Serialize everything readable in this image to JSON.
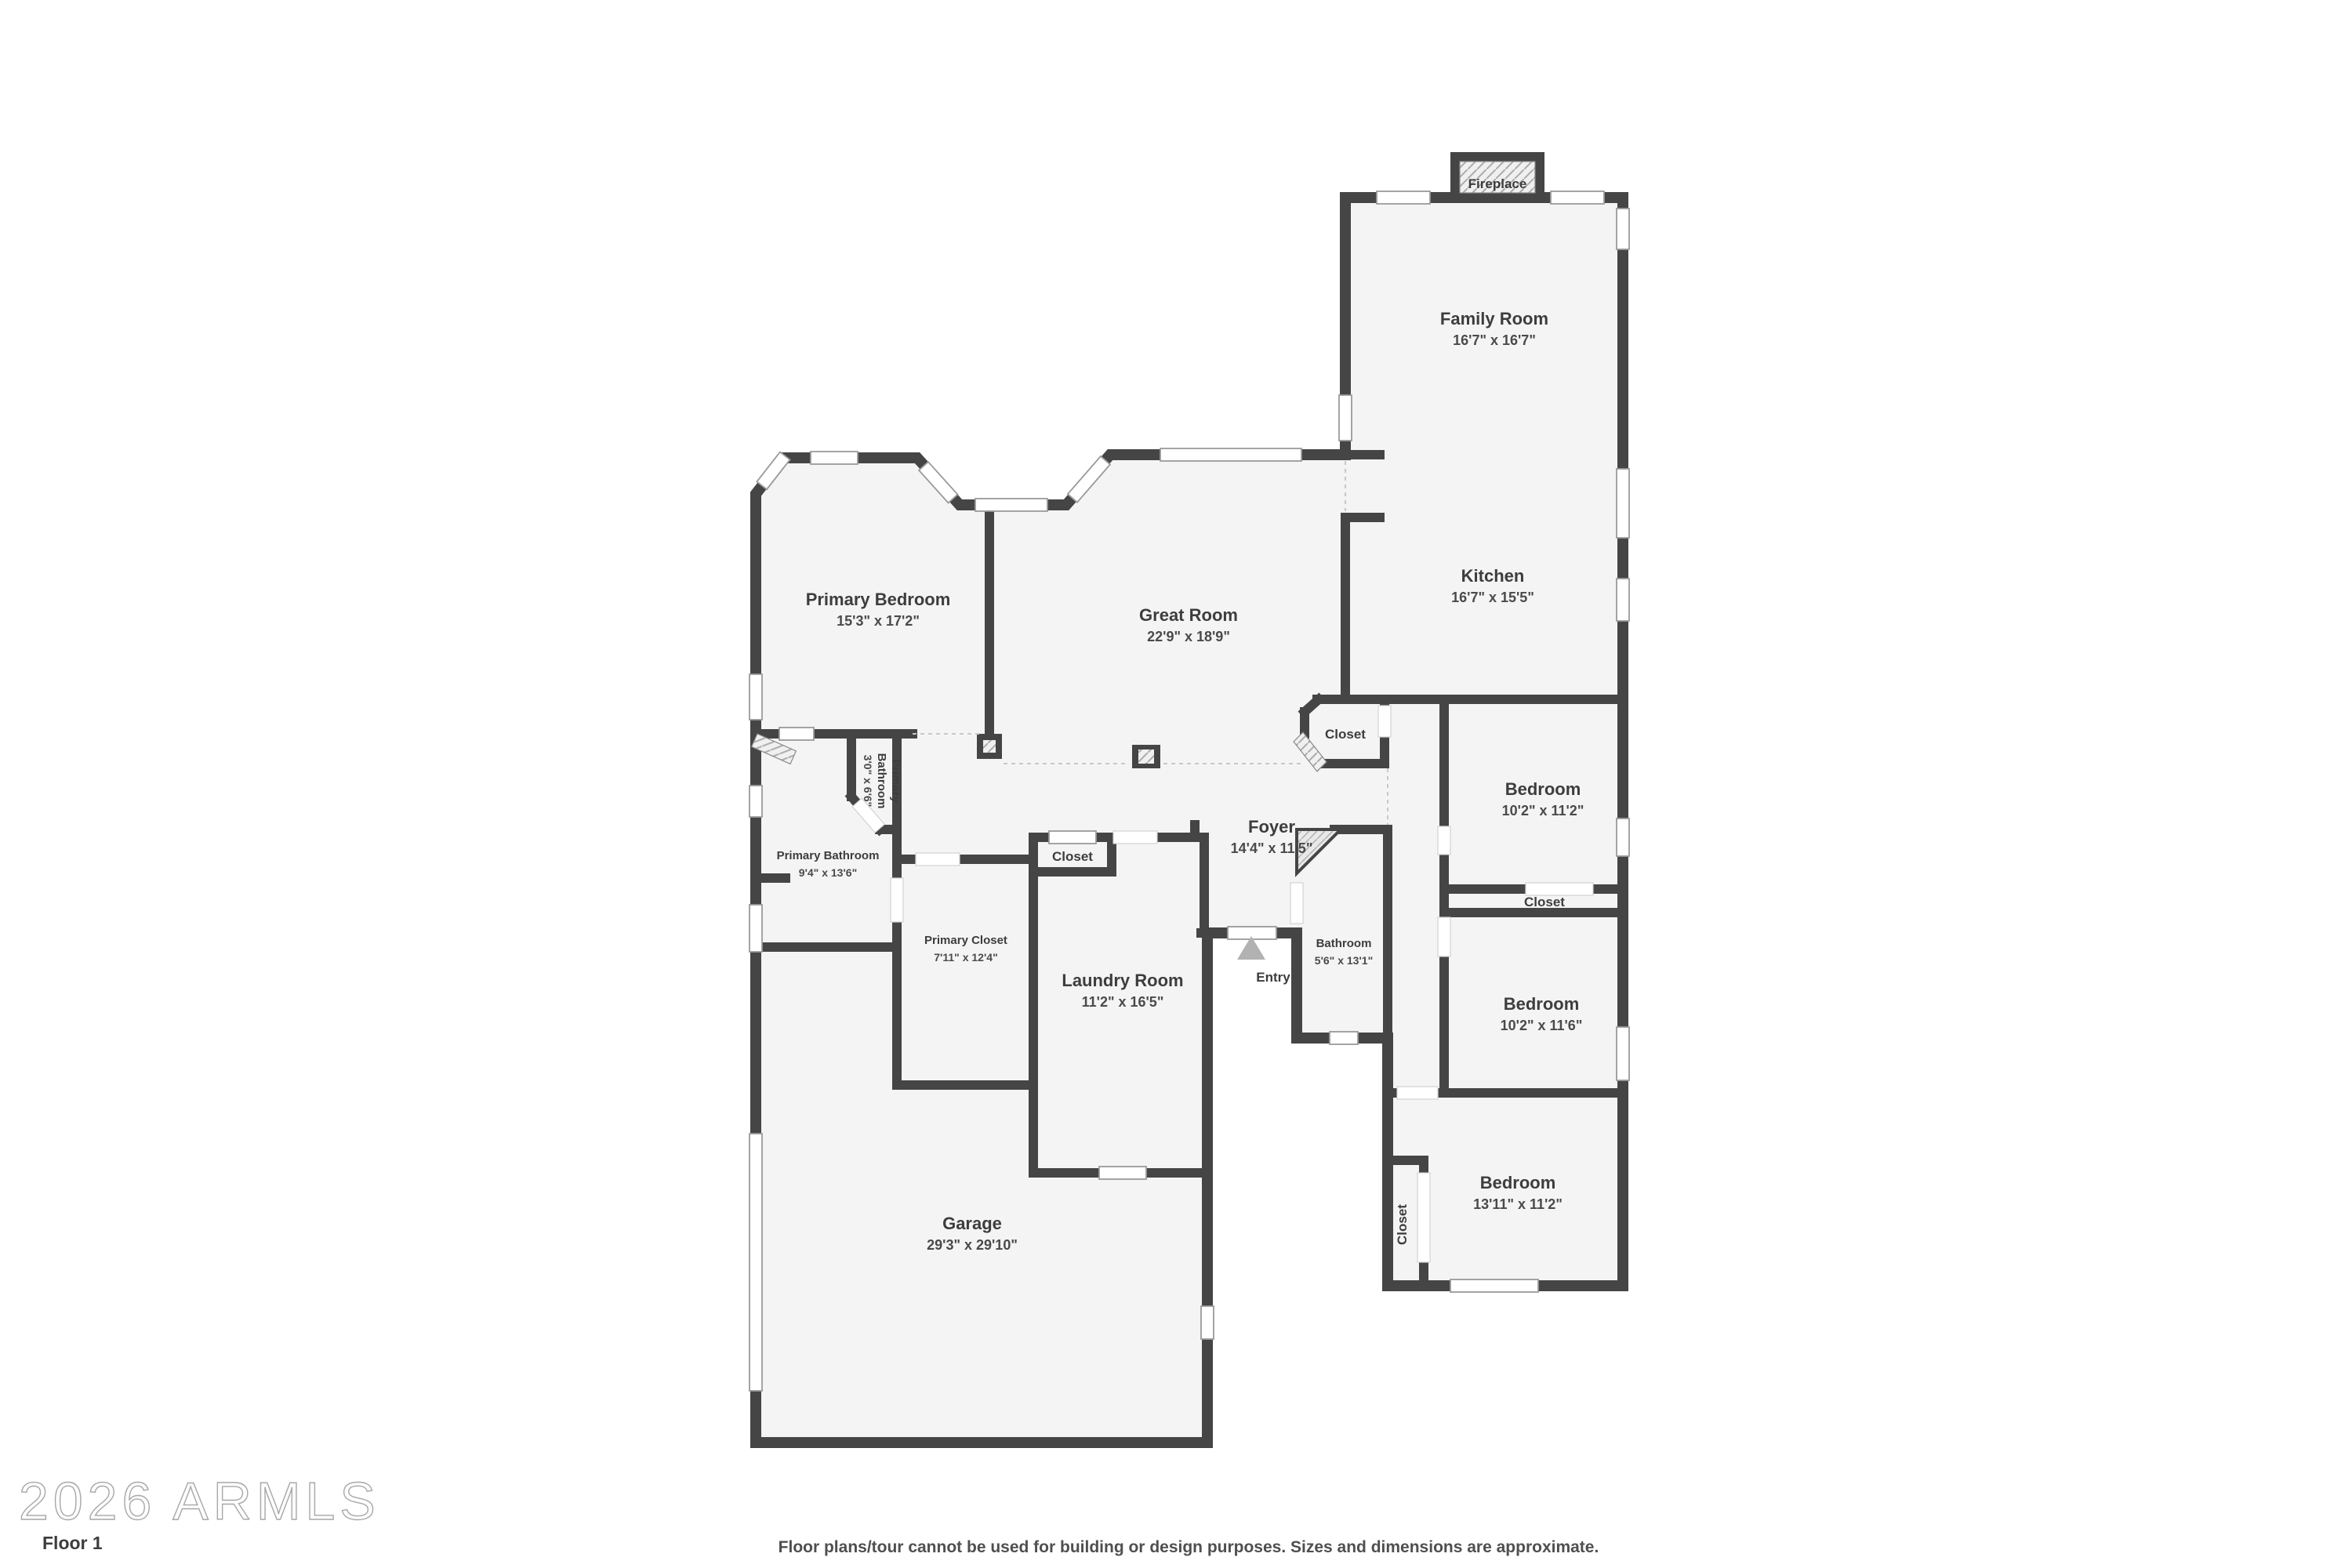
{
  "floorplan": {
    "rooms": {
      "family_room": {
        "name": "Family Room",
        "dims": "16'7\" x 16'7\""
      },
      "kitchen": {
        "name": "Kitchen",
        "dims": "16'7\" x 15'5\""
      },
      "primary_bedroom": {
        "name": "Primary Bedroom",
        "dims": "15'3\" x 17'2\""
      },
      "great_room": {
        "name": "Great Room",
        "dims": "22'9\" x 18'9\""
      },
      "foyer": {
        "name": "Foyer",
        "dims": "14'4\" x 11'5\""
      },
      "laundry_room": {
        "name": "Laundry Room",
        "dims": "11'2\" x 16'5\""
      },
      "primary_closet": {
        "name": "Primary Closet",
        "dims": "7'11\" x 12'4\""
      },
      "primary_bathroom": {
        "name": "Primary Bathroom",
        "dims": "9'4\" x 13'6\""
      },
      "primary_water_closet": {
        "name_line1": "Primary",
        "name_line2": "Bathroom",
        "dims": "3'0\" x 6'6\""
      },
      "bathroom": {
        "name": "Bathroom",
        "dims": "5'6\" x 13'1\""
      },
      "bedroom_top": {
        "name": "Bedroom",
        "dims": "10'2\" x 11'2\""
      },
      "bedroom_middle": {
        "name": "Bedroom",
        "dims": "10'2\" x 11'6\""
      },
      "bedroom_bottom": {
        "name": "Bedroom",
        "dims": "13'11\" x 11'2\""
      },
      "garage": {
        "name": "Garage",
        "dims": "29'3\" x 29'10\""
      },
      "closet_foyer": {
        "name": "Closet"
      },
      "closet_laundry": {
        "name": "Closet"
      },
      "closet_hall": {
        "name": "Closet"
      },
      "closet_bedroom": {
        "name": "Closet"
      },
      "entry": {
        "name": "Entry"
      },
      "fireplace": {
        "name": "Fireplace"
      }
    },
    "watermark": "2026 ARMLS",
    "floor_label": "Floor 1",
    "disclaimer": "Floor plans/tour cannot be used for building or design purposes. Sizes and dimensions are approximate.",
    "colors": {
      "wall": "#454545",
      "room_fill": "#f4f4f4",
      "background": "#ffffff",
      "text": "#3d3d3d"
    }
  }
}
